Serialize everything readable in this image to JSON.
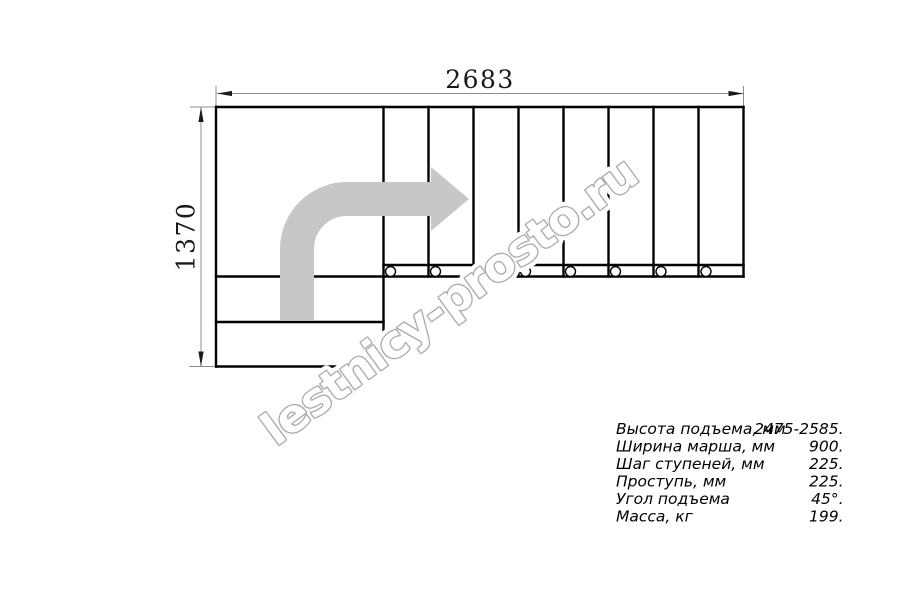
{
  "dimensions": {
    "width_label": "2683",
    "height_label": "1370"
  },
  "watermark": {
    "text": "lestnicy-prosto.ru"
  },
  "specs": {
    "rows": [
      {
        "label": "Высота подъема, мм",
        "value": "2475-2585."
      },
      {
        "label": "Ширина марша, мм",
        "value": "900."
      },
      {
        "label": "Шаг ступеней, мм",
        "value": "225."
      },
      {
        "label": "Проступь, мм",
        "value": "225."
      },
      {
        "label": "Угол подъема",
        "value": "45°."
      },
      {
        "label": "Масса, кг",
        "value": "199."
      }
    ]
  },
  "plan": {
    "treads_count": 8,
    "lower_steps_count": 2,
    "fastener_circles_count": 8
  },
  "colors": {
    "line": "#000000",
    "dim": "#8c8c8c",
    "arrow": "#c7c7c9",
    "wm_stroke": "#ababab"
  }
}
